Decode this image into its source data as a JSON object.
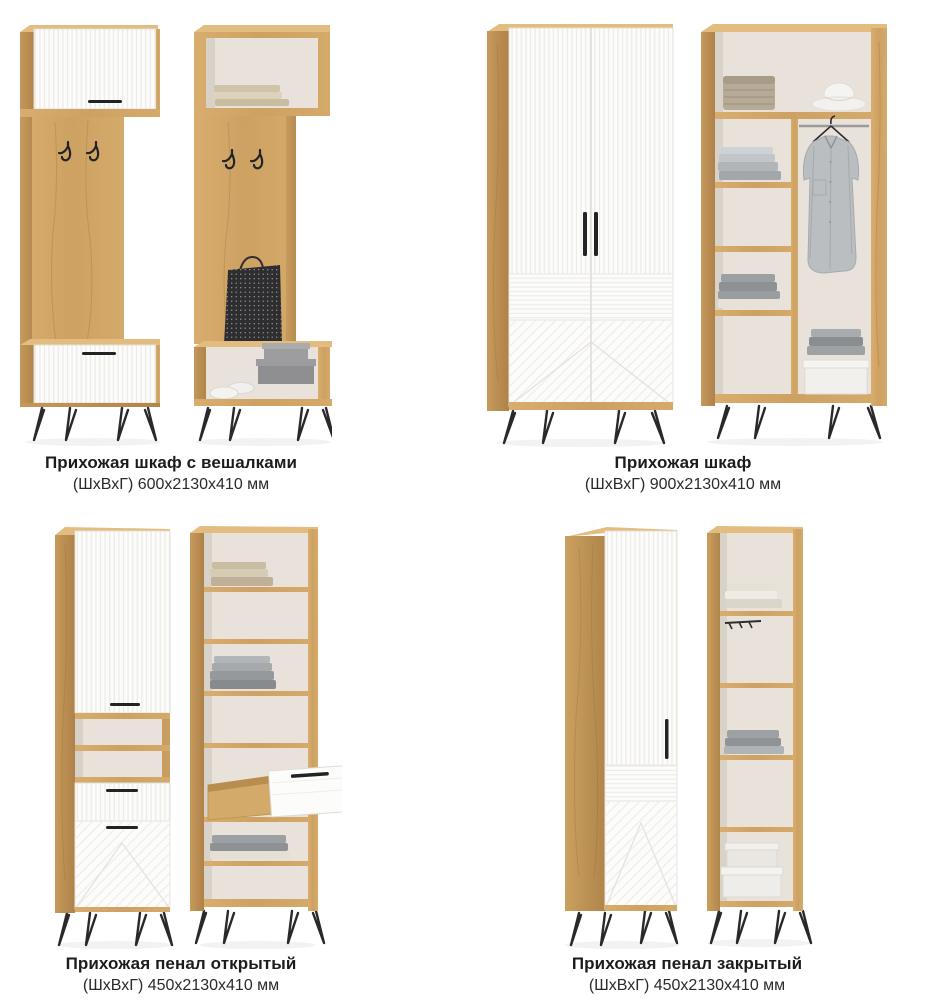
{
  "page": {
    "background": "#ffffff",
    "type_hint": "furniture catalog sheet, 2x2 grid, each product shown closed and open"
  },
  "colors": {
    "wood_front": "#d2a766",
    "wood_side": "#bb904f",
    "wood_top": "#e2bb80",
    "panel_white": "#fcfcfb",
    "interior_back": "#e8e2db",
    "hardware_black": "#232325",
    "text": "#1c1c1e"
  },
  "products": [
    {
      "title": "Прихожая шкаф с вешалками",
      "dimensions": "(ШхВхГ) 600х2130х410 мм"
    },
    {
      "title": "Прихожая шкаф",
      "dimensions": "(ШхВхГ) 900х2130х410 мм"
    },
    {
      "title": "Прихожая пенал открытый",
      "dimensions": "(ШхВхГ) 450х2130х410 мм"
    },
    {
      "title": "Прихожая пенал закрытый",
      "dimensions": "(ШхВхГ) 450х2130х410 мм"
    }
  ]
}
